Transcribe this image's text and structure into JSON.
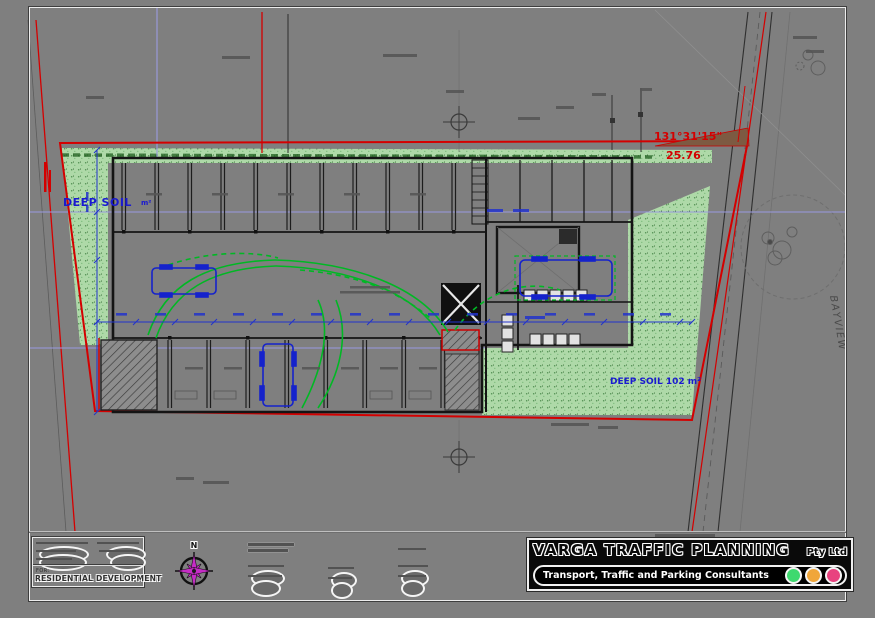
{
  "plan": {
    "deep_soil_left": "DEEP SOIL",
    "deep_soil_left_unit": "m²",
    "deep_soil_right": "DEEP SOIL 102 m²",
    "bearing_top": "131°31'15\"",
    "distance_top": "25.76",
    "street_name": "BAYVIEW"
  },
  "compass": {
    "north": "N"
  },
  "title_block": {
    "for_label": "FOR:",
    "project": "RESIDENTIAL DEVELOPMENT",
    "company": "VARGA TRAFFIC PLANNING",
    "company_suffix": "Pty Ltd",
    "tagline": "Transport, Traffic and Parking Consultants",
    "traffic_lights": {
      "green": "#3fd96f",
      "amber": "#f0a63a",
      "red": "#e8427f"
    }
  }
}
